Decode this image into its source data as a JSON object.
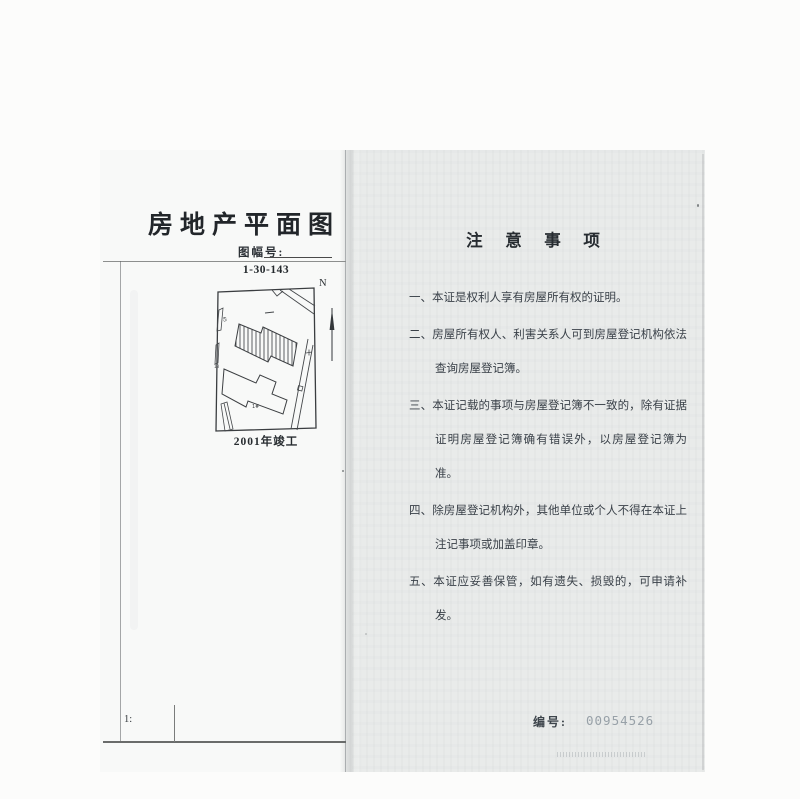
{
  "document": {
    "left_page": {
      "title": "房地产平面图",
      "sheet_label": "图幅号:",
      "scale_label": "1:",
      "plan": {
        "code": "1-30-143",
        "north": "N",
        "completion": "2001年竣工",
        "building_label": "1#",
        "parcel_label_left": "65",
        "parcel_label_lower": "18"
      }
    },
    "right_page": {
      "title": "注 意 事 项",
      "notes": [
        {
          "marker": "一、",
          "text": "本证是权利人享有房屋所有权的证明。"
        },
        {
          "marker": "二、",
          "text": "房屋所有权人、利害关系人可到房屋登记机构依法查询房屋登记簿。"
        },
        {
          "marker": "三、",
          "text": "本证记载的事项与房屋登记簿不一致的，除有证据证明房屋登记簿确有错误外，以房屋登记簿为准。"
        },
        {
          "marker": "四、",
          "text": "除房屋登记机构外，其他单位或个人不得在本证上注记事项或加盖印章。"
        },
        {
          "marker": "五、",
          "text": "本证应妥善保管，如有遗失、损毁的，可申请补发。"
        }
      ],
      "serial_label": "编号:",
      "serial_number": "00954526"
    },
    "colors": {
      "ink": "#2e3338",
      "serial_number": "#98a1a8",
      "left_page_bg": "#f8f9f8",
      "right_page_bg": "#e9ebea"
    }
  }
}
